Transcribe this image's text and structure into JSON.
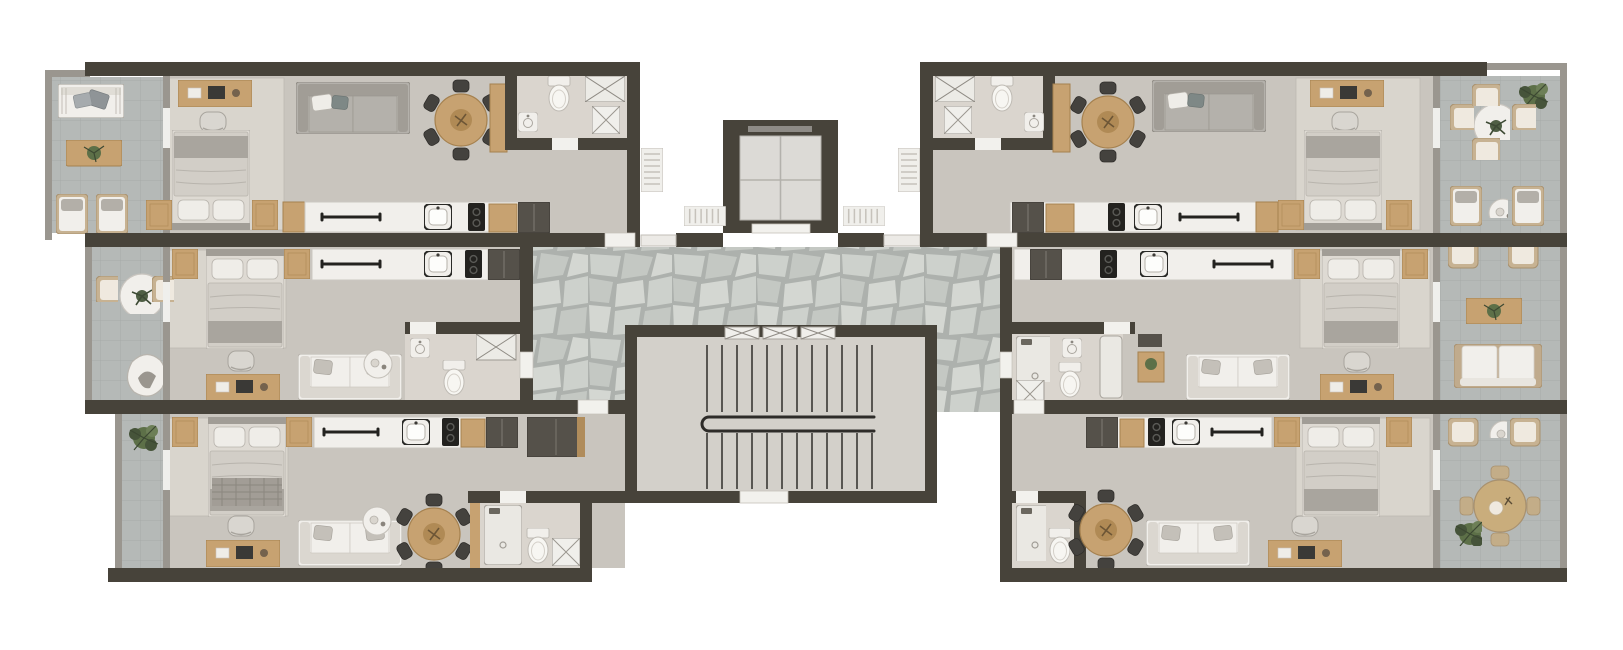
{
  "page": {
    "background": "#ffffff",
    "description": "Top-down 3D rendered residential floor plan: six studio apartments in two mirrored wings around a central elevator and stair core"
  },
  "palette": {
    "bg": "#ffffff",
    "wall": "#47433a",
    "wallEdge": "#5c584f",
    "wallLight": "#9a968f",
    "floor": "#c9c5be",
    "floorLight": "#d2cec7",
    "rug": "#d9d5cd",
    "bath": "#dad5ce",
    "balconyTile": "#b5b9b7",
    "balconyGrout": "#a6aaa8",
    "flagGrout": "#adb1ad",
    "stone1": "#cdd1cc",
    "stone2": "#c4c8c3",
    "stone3": "#d4d7d2",
    "stairFloor": "#d3d0ca",
    "wood": "#c7a271",
    "woodDark": "#a5814f",
    "whiteFurn": "#f1efeb",
    "furnStroke": "#b8b4ad",
    "sofaGray": "#b4b1ab",
    "sofaBack": "#a19d96",
    "darkFurn": "#55514a",
    "black": "#23221f",
    "metal": "#8e8b86",
    "green": "#5d7048",
    "greenDark": "#46543a",
    "duvet": "#dedad3",
    "pillow": "#efede8",
    "blanket": "#a9a59e",
    "tread": "#3a3834"
  },
  "core": {
    "elevator": "elevator cab with crossed door lines at top center",
    "stairwell": "double-flight staircase with central handrail and landing",
    "hallway_floor": "irregular flagstone paving",
    "stair_windows": 3,
    "radiators": 4
  },
  "units": [
    {
      "id": "left-top",
      "position": "north-west",
      "rooms": [
        "balcony",
        "bedroom",
        "living-dining",
        "kitchen",
        "bathroom"
      ],
      "furniture": [
        "bench-sofa",
        "outdoor-coffee-table",
        "outdoor-lounge-chairs",
        "desk",
        "desk-chair",
        "double-bed",
        "nightstands",
        "sofa",
        "round-dining-table",
        "dining-chairs",
        "sideboard",
        "kitchen-counter",
        "kitchen-sink",
        "cooktop",
        "fridge",
        "toilet",
        "washbasin",
        "shower",
        "washing-machine"
      ]
    },
    {
      "id": "left-middle",
      "position": "west",
      "rooms": [
        "balcony",
        "bedroom",
        "living",
        "kitchen",
        "bathroom"
      ],
      "furniture": [
        "bistro-table",
        "organic-armchair",
        "double-bed",
        "nightstands",
        "desk",
        "desk-chair",
        "sofa",
        "side-table",
        "kitchen-counter",
        "kitchen-sink",
        "cooktop",
        "fridge",
        "toilet",
        "washbasin",
        "shower"
      ]
    },
    {
      "id": "left-bottom",
      "position": "south-west",
      "rooms": [
        "balcony",
        "bedroom",
        "living-dining",
        "kitchen",
        "bathroom",
        "entry"
      ],
      "furniture": [
        "plant",
        "double-bed-plaid-throw",
        "nightstands",
        "desk",
        "desk-chair",
        "sofa",
        "side-table",
        "round-dining-table",
        "dining-chairs",
        "kitchen-counter",
        "kitchen-sink",
        "cooktop",
        "fridge",
        "wardrobe",
        "toilet",
        "shower",
        "washing-machine"
      ]
    },
    {
      "id": "right-top",
      "position": "north-east",
      "rooms": [
        "bathroom",
        "living-dining",
        "kitchen",
        "bedroom",
        "balcony"
      ],
      "furniture": [
        "round-dining-table",
        "dining-chairs",
        "sofa",
        "desk",
        "desk-chair",
        "double-bed",
        "nightstands",
        "sideboard",
        "kitchen-counter",
        "kitchen-sink",
        "cooktop",
        "fridge",
        "toilet",
        "washbasin",
        "shower",
        "washing-machine",
        "outdoor-round-table",
        "wicker-chairs",
        "lounge-chairs",
        "plant"
      ]
    },
    {
      "id": "right-middle",
      "position": "east",
      "rooms": [
        "bathroom",
        "living",
        "kitchen",
        "bedroom",
        "balcony"
      ],
      "furniture": [
        "shower",
        "toilet",
        "washbasin",
        "bathtub",
        "side-table",
        "sofa",
        "desk",
        "double-bed",
        "nightstands",
        "kitchen-counter",
        "kitchen-sink",
        "cooktop",
        "fridge",
        "wicker-armchairs",
        "outdoor-coffee-table",
        "outdoor-loveseat"
      ]
    },
    {
      "id": "right-bottom",
      "position": "south-east",
      "rooms": [
        "bathroom",
        "living-dining",
        "kitchen",
        "bedroom",
        "balcony"
      ],
      "furniture": [
        "shower",
        "toilet",
        "round-dining-table",
        "dining-chairs",
        "sofa",
        "desk",
        "desk-chair",
        "double-bed",
        "nightstands",
        "kitchen-counter",
        "kitchen-sink",
        "cooktop",
        "fridge",
        "wicker-armchairs",
        "outdoor-dining-table",
        "plant"
      ]
    }
  ]
}
